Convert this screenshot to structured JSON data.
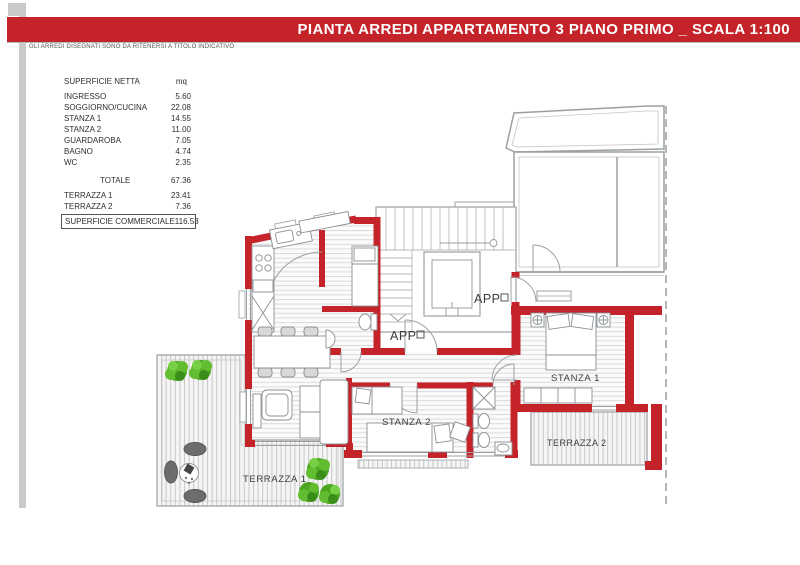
{
  "header": {
    "title": "PIANTA ARREDI APPARTAMENTO 3 PIANO PRIMO _ SCALA 1:100",
    "disclaimer": "GLI ARREDI DISEGNATI SONO DA RITENERSI A TITOLO INDICATIVO"
  },
  "table": {
    "title": "SUPERFICIE NETTA",
    "unit": "mq",
    "rows": [
      {
        "label": "INGRESSO",
        "value": "5.60"
      },
      {
        "label": "SOGGIORNO/CUCINA",
        "value": "22.08"
      },
      {
        "label": "STANZA 1",
        "value": "14.55"
      },
      {
        "label": "STANZA 2",
        "value": "11.00"
      },
      {
        "label": "GUARDAROBA",
        "value": "7.05"
      },
      {
        "label": "BAGNO",
        "value": "4.74"
      },
      {
        "label": "WC",
        "value": "2.35"
      }
    ],
    "total": {
      "label": "TOTALE",
      "value": "67.36"
    },
    "terraces": [
      {
        "label": "TERRAZZA 1",
        "value": "23.41"
      },
      {
        "label": "TERRAZZA 2",
        "value": "7.36"
      }
    ],
    "commercial": {
      "label": "SUPERFICIE COMMERCIALE",
      "value": "116.53"
    }
  },
  "plan": {
    "labels": {
      "app_upper": "APP",
      "app_lower": "APP",
      "stanza1": "STANZA 1",
      "stanza2": "STANZA 2",
      "terrazza1": "TERRAZZA 1",
      "terrazza2": "TERRAZZA 2"
    }
  },
  "colors": {
    "accent_red": "#c5232a",
    "neighbor_gray": "#9aa0a3",
    "plant_green": "#4aa51f",
    "sidebar_gray": "#c9c9c9"
  }
}
